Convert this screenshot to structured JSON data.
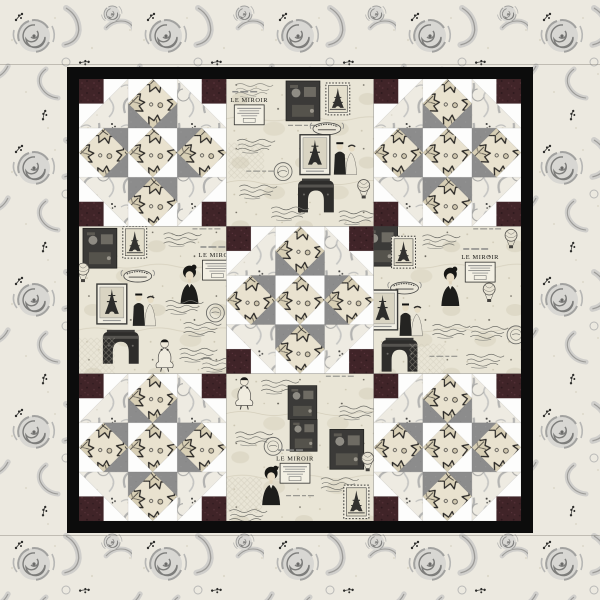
{
  "image": {
    "kind": "quilt product photo",
    "description": "Square wall quilt with gray rose floral outer border, black inner frame, 3x3 grid alternating pieced Union Square blocks and Paris toile print blocks",
    "width_px": 600,
    "height_px": 600
  },
  "quilt": {
    "outer_border": {
      "fabric": "gray roses and feather scrolls with black sprigs on cream",
      "width_px": 67,
      "seam_inset_px": 64
    },
    "inner_border": {
      "color": "#0c0c0c",
      "thickness_px": 12
    },
    "grid": {
      "rows": 3,
      "cols": 3,
      "block_size_px": 147,
      "blocks": [
        [
          "pieced",
          "paris",
          "pieced"
        ],
        [
          "paris",
          "pieced",
          "paris"
        ],
        [
          "pieced",
          "paris",
          "pieced"
        ]
      ]
    },
    "pieced_block": {
      "pattern_name": "union-square",
      "units_per_side": 6,
      "fabrics": {
        "corner_squares": "dark burgundy speckle",
        "inner_triangles": "solid medium gray",
        "background": "white",
        "corner_triangles": "gray paisley scroll on cream",
        "diamonds": "black outlined leaf damask on cream"
      }
    },
    "paris_fabric": {
      "label": "LE MIROIR",
      "motifs": [
        "le-miroir-advert",
        "eiffel-tower-framed-photo",
        "eiffel-tower-stamp",
        "arc-de-triomphe",
        "woman-portrait",
        "vintage-couple",
        "pierrot-clown",
        "handwritten-script",
        "postmark-circle",
        "crest-banner",
        "dark-photo-collage",
        "lattice-patch",
        "hot-air-balloon"
      ]
    },
    "palette": {
      "cream": "#ece9e0",
      "paris_cream": "#e9e5d6",
      "leaf_cream": "#e9e2cf",
      "gray": "#8c8c8c",
      "rose_gray": "#a9a8a6",
      "black": "#0c0c0c",
      "burgundy": "#402428",
      "ink": "#2b2a28",
      "white": "#fdfdfc"
    }
  }
}
